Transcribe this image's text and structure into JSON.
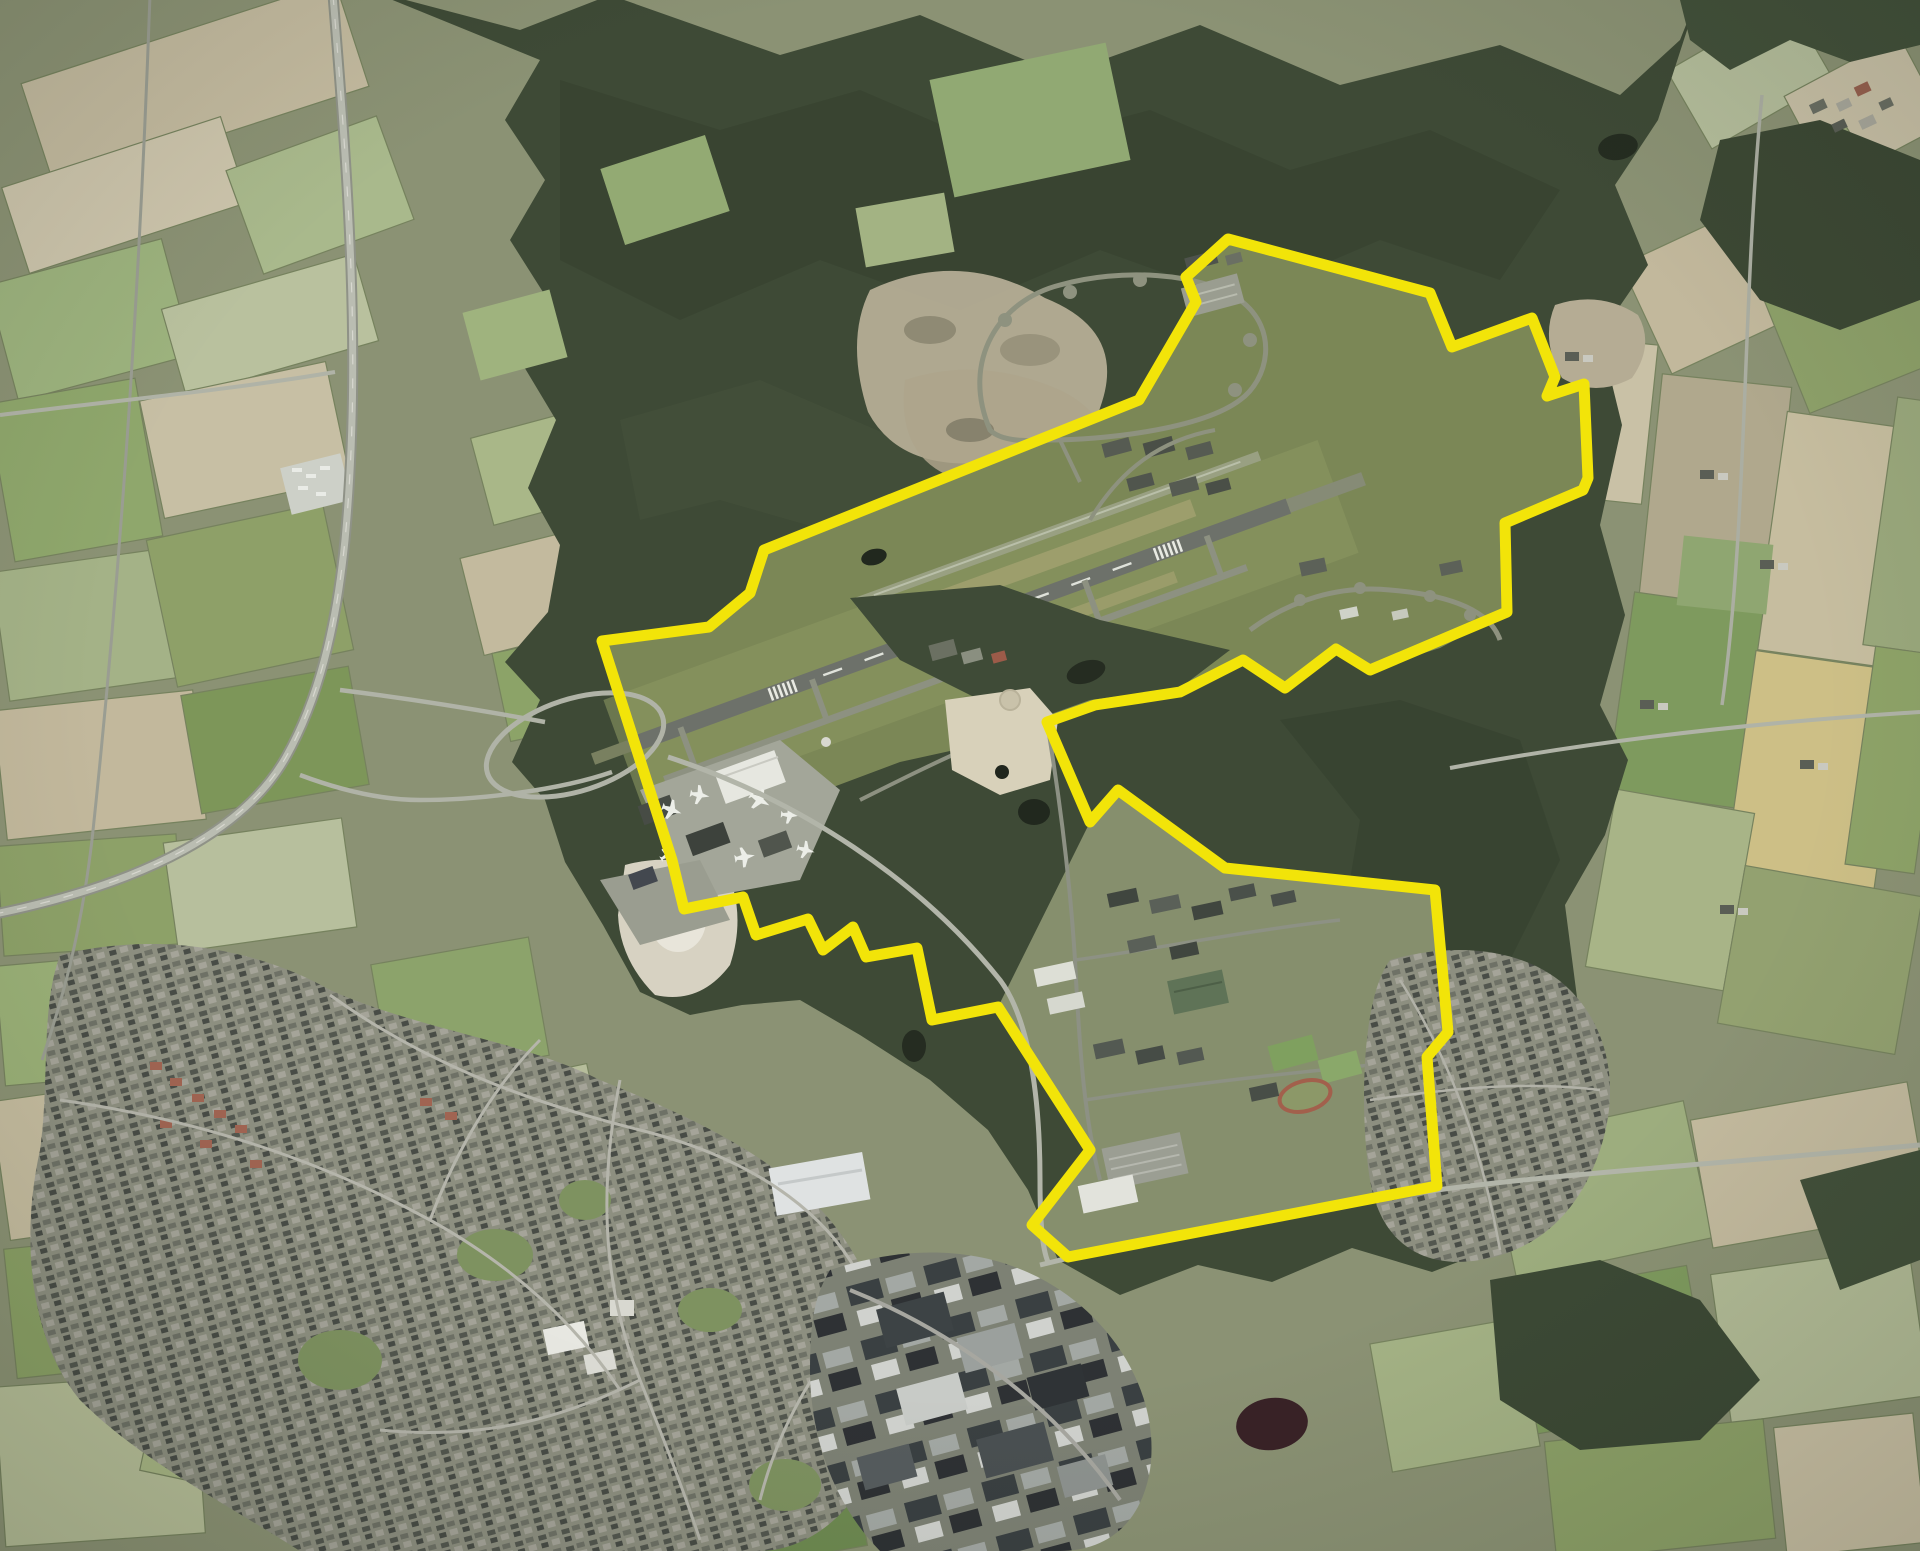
{
  "scene": {
    "type": "aerial-orthophoto",
    "description": "Aerial photograph of a former military airbase (runway, taxiways, dispersal loops, terminal apron with aircraft, southern barracks camp) surrounded by forest, heathland, farm fields, a motorway and a town, with the site perimeter drawn as a thick yellow boundary line.",
    "width_px": 1920,
    "height_px": 1551
  },
  "boundary": {
    "name": "site-boundary",
    "color": "#f2e409",
    "stroke_width": 11,
    "points": "602,641 709,627 750,593 764,550 1139,400 1196,302 1186,277 1228,239 1430,293 1452,347 1532,318 1555,377 1547,396 1584,384 1588,478 1583,490 1505,523 1507,612 1370,670 1336,649 1285,688 1243,660 1180,692 1095,705 1047,722 1090,822 1118,790 1225,868 1435,890 1448,1032 1427,1057 1437,1186 1068,1257 1032,1225 1090,1150 998,1007 932,1020 917,948 866,957 853,927 823,950 808,919 756,935 743,897 684,909 672,860"
  },
  "airfield": {
    "grass_points": "602,641 709,627 750,593 764,550 1139,400 1196,302 1186,277 1228,239 1430,293 1452,347 1532,318 1555,377 1547,396 1584,384 1588,478 1583,490 1505,523 1507,612 1440,648 1370,670 1336,649 1285,688 1243,660 1180,692 1095,705 1047,722 1000,740 900,762 820,792 757,822 700,862 684,909 672,860",
    "runway_heading_deg": -20
  },
  "palette": {
    "farmland_base": "#8b9274",
    "forest": "#3e4a36",
    "forest_dark": "#34402e",
    "field_green": "#8ca368",
    "field_pale": "#c3ba9e",
    "airfield_grass": "#7b8756",
    "runway_asphalt": "#6d716a",
    "taxiway": "#8d9181",
    "town_base": "#8d8f80",
    "industry_base": "#7d8174",
    "heath": "#b9b098",
    "sand": "#d8d1ba",
    "water": "#252c21",
    "road": "#b2b5a9",
    "boundary_yellow": "#f2e409"
  },
  "features": {
    "labels": [
      "farm-fields",
      "forest",
      "heathland",
      "sand-quarry",
      "main-runway",
      "runway-extension",
      "parallel-taxiway",
      "north-runway",
      "dispersal-loop-north",
      "dispersal-loop-east",
      "perimeter-parking",
      "terminal-apron",
      "aircraft",
      "hangars",
      "monument-sand-area",
      "south-camp-clearing",
      "barracks",
      "running-track",
      "large-parking-lot",
      "town",
      "town-streets",
      "industrial-park",
      "village-east",
      "hamlet-northeast",
      "motorway",
      "interchange-loop",
      "railway",
      "rural-roads",
      "ponds",
      "site-boundary"
    ]
  }
}
